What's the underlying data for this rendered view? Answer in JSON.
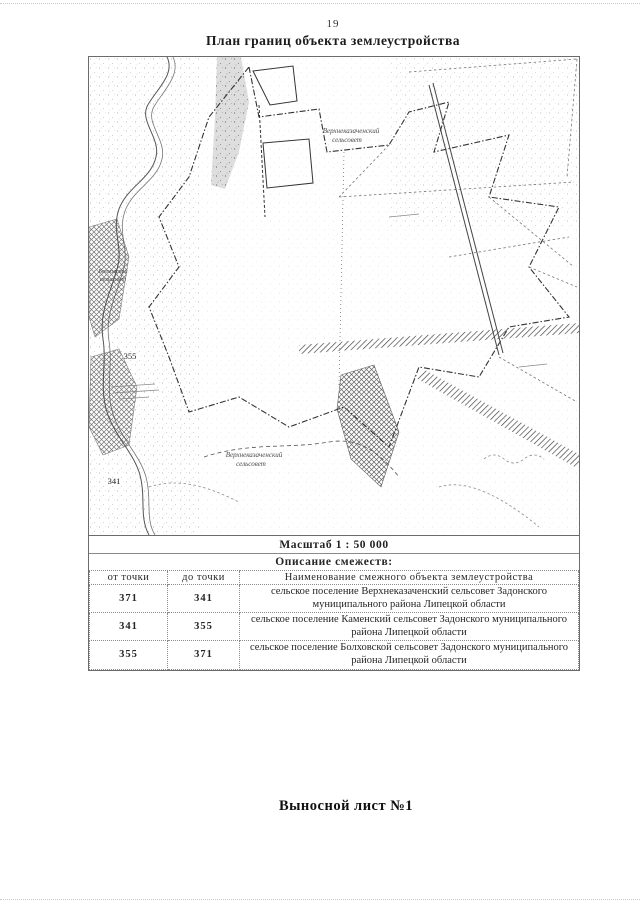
{
  "page": {
    "number": "19",
    "title": "План границ объекта землеустройства",
    "footer": "Выносной лист №1"
  },
  "map": {
    "caption": "Масштаб 1 : 50 000",
    "labels": {
      "settlement_top_line1": "Верхнеказаченский",
      "settlement_top_line2": "сельсовет",
      "settlement_left_line1": "Болховской",
      "settlement_left_line2": "сельсовет",
      "settlement_bottom_line1": "Верхнеказаченский",
      "settlement_bottom_line2": "сельсовет",
      "point_355": "355",
      "point_341": "341"
    }
  },
  "table": {
    "title": "Описание смежеств:",
    "columns": [
      "от точки",
      "до точки",
      "Наименование смежного объекта землеустройства"
    ],
    "rows": [
      {
        "from": "371",
        "to": "341",
        "name": "сельское поселение Верхнеказаченский сельсовет Задонского муниципального района Липецкой области"
      },
      {
        "from": "341",
        "to": "355",
        "name": "сельское поселение Каменский сельсовет Задонского муниципального района Липецкой области"
      },
      {
        "from": "355",
        "to": "371",
        "name": "сельское поселение Болховской сельсовет Задонского муниципального района Липецкой области"
      }
    ]
  }
}
